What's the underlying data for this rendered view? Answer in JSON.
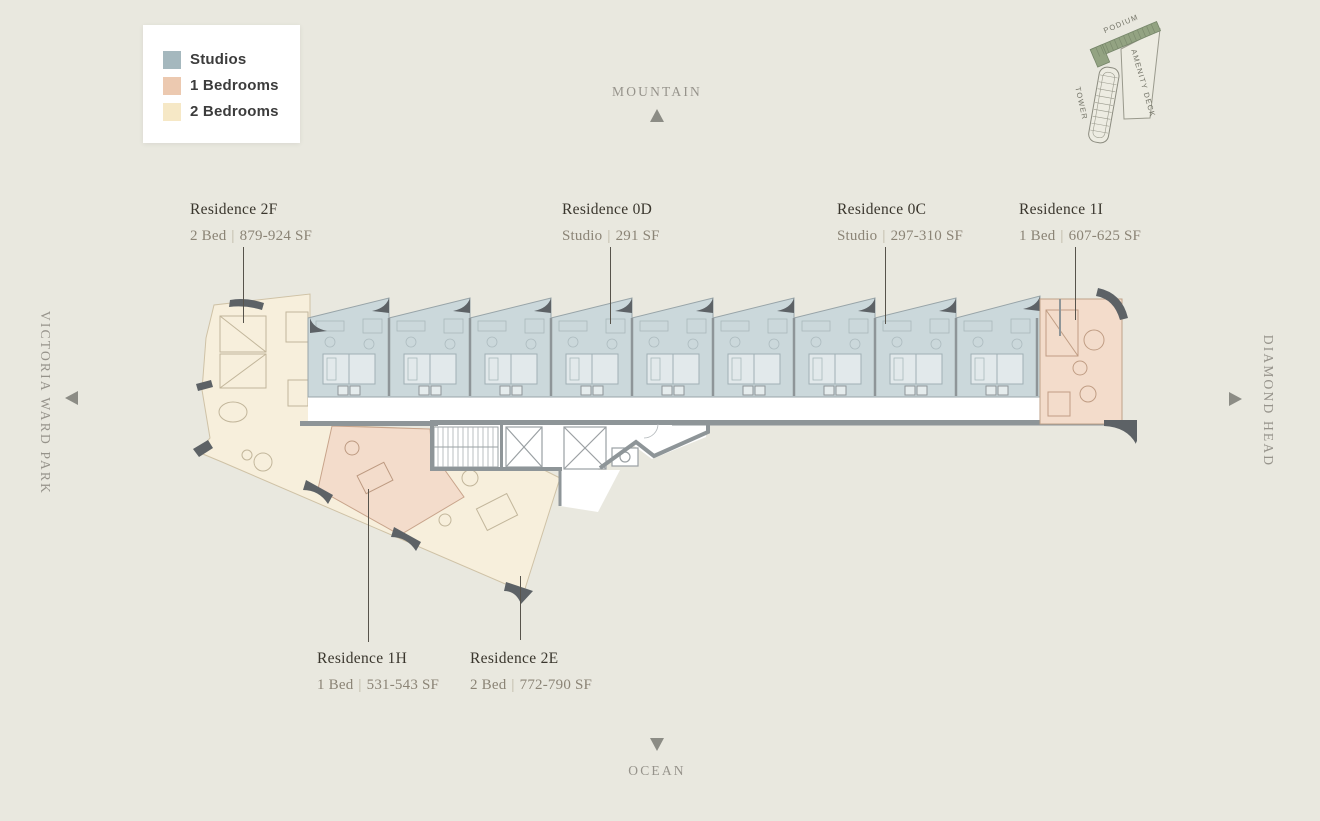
{
  "colors": {
    "bg": "#e9e8df",
    "studio_fill": "#cbd8db",
    "one_bed_fill": "#f3dccb",
    "two_bed_fill": "#f7efdc",
    "studio_swatch": "#a5b8be",
    "one_bed_swatch": "#ecc9b0",
    "two_bed_swatch": "#f6e8c6",
    "wall": "#8e9598",
    "wall_dark": "#5d6266",
    "podium_green": "#93a382",
    "text_dark": "#3a362d",
    "text_muted": "#8b8476",
    "compass": "#96938b",
    "leader": "#57534b"
  },
  "legend": {
    "items": [
      {
        "label": "Studios"
      },
      {
        "label": "1 Bedrooms"
      },
      {
        "label": "2 Bedrooms"
      }
    ]
  },
  "compass": {
    "north": "MOUNTAIN",
    "south": "OCEAN",
    "west": "VICTORIA WARD PARK",
    "east": "DIAMOND HEAD"
  },
  "sitemap": {
    "podium": "PODIUM",
    "amenity_deck": "AMENITY DECK",
    "tower": "TOWER"
  },
  "separator": "|",
  "residences": [
    {
      "id": "2F",
      "title": "Residence 2F",
      "type": "2 Bed",
      "area": "879-924 SF"
    },
    {
      "id": "0D",
      "title": "Residence 0D",
      "type": "Studio",
      "area": "291 SF"
    },
    {
      "id": "0C",
      "title": "Residence 0C",
      "type": "Studio",
      "area": "297-310 SF"
    },
    {
      "id": "1I",
      "title": "Residence 1I",
      "type": "1 Bed",
      "area": "607-625 SF"
    },
    {
      "id": "1H",
      "title": "Residence 1H",
      "type": "1 Bed",
      "area": "531-543 SF"
    },
    {
      "id": "2E",
      "title": "Residence 2E",
      "type": "2 Bed",
      "area": "772-790 SF"
    }
  ]
}
